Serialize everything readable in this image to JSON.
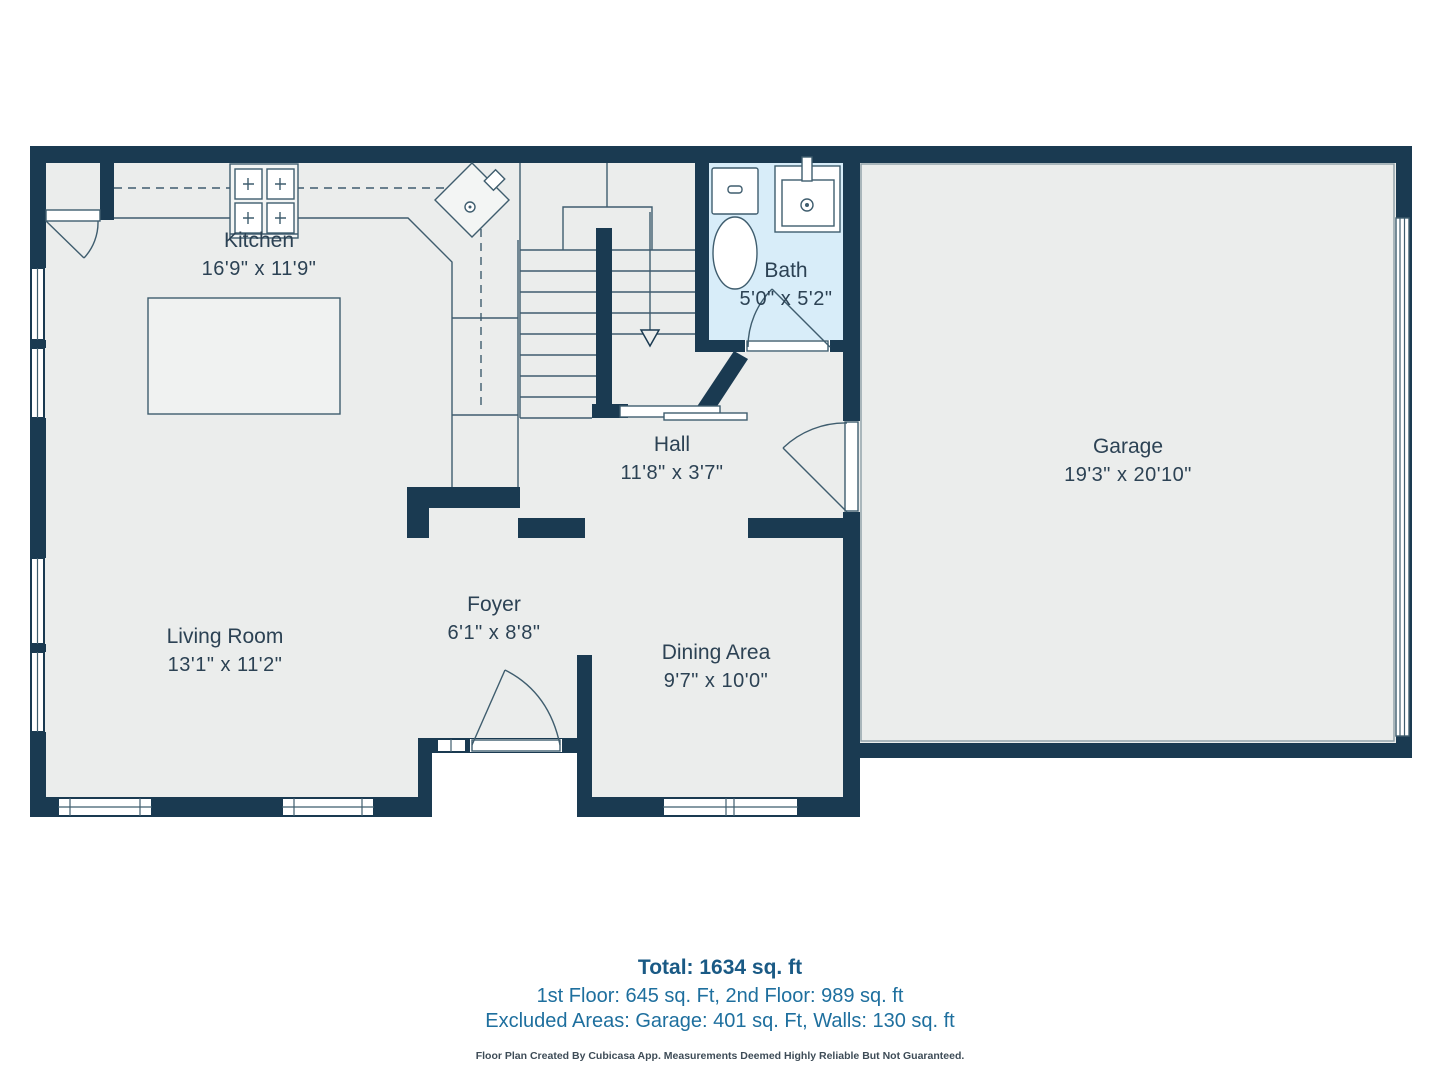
{
  "colors": {
    "wall": "#1a3a51",
    "floor": "#ebedec",
    "bath": "#d8edf9",
    "line": "#3f5d6e",
    "label": "#2c4254",
    "total": "#1a5a85",
    "breakdown": "#1e6f9e",
    "disclaimer": "#3e4c57"
  },
  "rooms": [
    {
      "name": "Kitchen",
      "dims": "16'9\" x 11'9\""
    },
    {
      "name": "Bath",
      "dims": "5'0\" x 5'2\""
    },
    {
      "name": "Garage",
      "dims": "19'3\" x 20'10\""
    },
    {
      "name": "Hall",
      "dims": "11'8\" x 3'7\""
    },
    {
      "name": "Foyer",
      "dims": "6'1\" x 8'8\""
    },
    {
      "name": "Living Room",
      "dims": "13'1\" x 11'2\""
    },
    {
      "name": "Dining Area",
      "dims": "9'7\" x 10'0\""
    }
  ],
  "fixtures": [
    "stove-icon",
    "corner-sink-icon",
    "kitchen-island",
    "toilet-icon",
    "bathroom-sink-icon",
    "staircase-icon",
    "garage-door-icon"
  ],
  "footer": {
    "total": "Total: 1634 sq. ft",
    "line2": "1st Floor: 645 sq. Ft, 2nd Floor: 989 sq. ft",
    "line3": "Excluded Areas: Garage: 401 sq. Ft, Walls: 130 sq. ft",
    "disclaimer": "Floor Plan Created By Cubicasa App. Measurements Deemed Highly Reliable But Not Guaranteed."
  }
}
